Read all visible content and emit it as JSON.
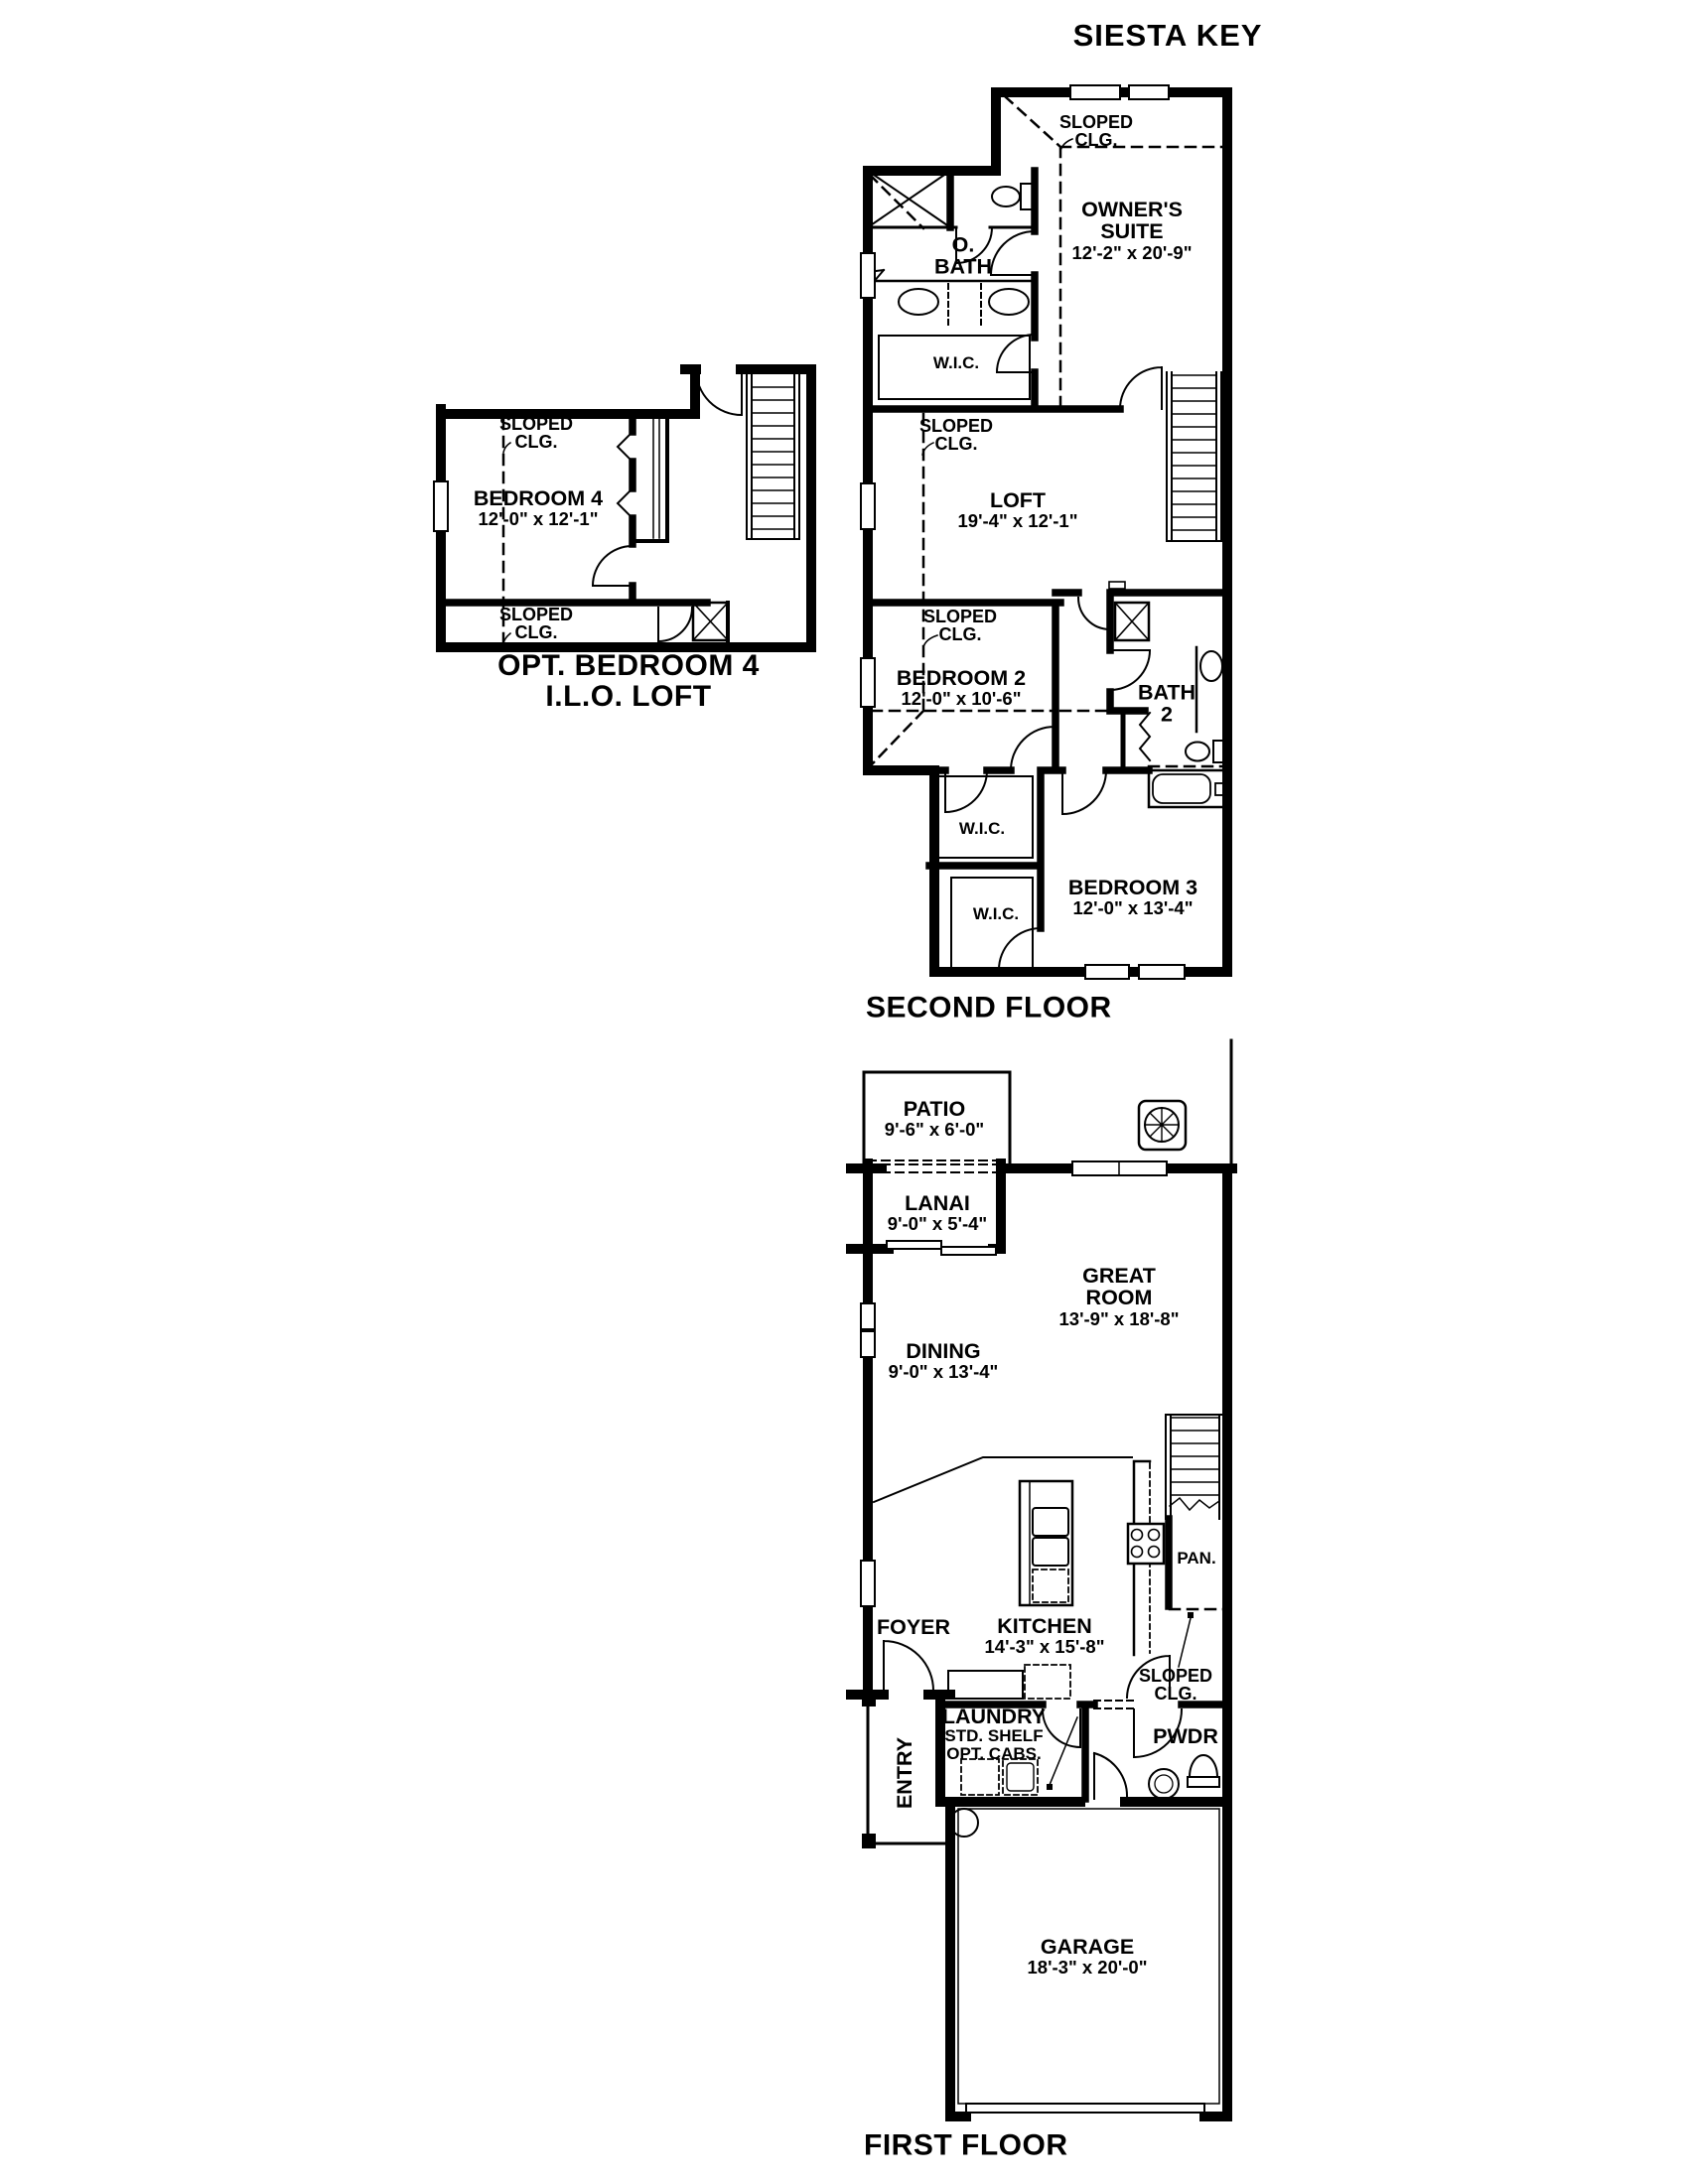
{
  "colors": {
    "ink": "#000000",
    "paper": "#ffffff"
  },
  "title": "SIESTA KEY",
  "sloped_note": {
    "line1": "SLOPED",
    "line2": "CLG."
  },
  "second_floor": {
    "caption": "SECOND FLOOR",
    "owners_suite": {
      "name1": "OWNER'S",
      "name2": "SUITE",
      "dims": "12'-2\" x 20'-9\""
    },
    "obath": {
      "line1": "O.",
      "line2": "BATH"
    },
    "wic_owner": "W.I.C.",
    "loft": {
      "name": "LOFT",
      "dims": "19'-4\" x 12'-1\""
    },
    "bedroom2": {
      "name": "BEDROOM 2",
      "dims": "12'-0\" x 10'-6\""
    },
    "bath2": {
      "line1": "BATH",
      "line2": "2"
    },
    "wic_bedroom2": "W.I.C.",
    "wic_bedroom3": "W.I.C.",
    "bedroom3": {
      "name": "BEDROOM 3",
      "dims": "12'-0\" x 13'-4\""
    }
  },
  "opt_bedroom4": {
    "caption1": "OPT. BEDROOM 4",
    "caption2": "I.L.O. LOFT",
    "bedroom4": {
      "name": "BEDROOM 4",
      "dims": "12'-0\" x 12'-1\""
    }
  },
  "first_floor": {
    "caption": "FIRST FLOOR",
    "patio": {
      "name": "PATIO",
      "dims": "9'-6\" x 6'-0\""
    },
    "lanai": {
      "name": "LANAI",
      "dims": "9'-0\" x 5'-4\""
    },
    "great_room": {
      "name1": "GREAT",
      "name2": "ROOM",
      "dims": "13'-9\" x 18'-8\""
    },
    "dining": {
      "name": "DINING",
      "dims": "9'-0\" x 13'-4\""
    },
    "kitchen": {
      "name": "KITCHEN",
      "dims": "14'-3\" x 15'-8\""
    },
    "foyer": "FOYER",
    "pantry": "PAN.",
    "entry": "ENTRY",
    "laundry": {
      "name": "LAUNDRY",
      "line2": "STD. SHELF",
      "line3": "OPT. CABS."
    },
    "powder": "PWDR",
    "garage": {
      "name": "GARAGE",
      "dims": "18'-3\" x 20'-0\""
    }
  }
}
